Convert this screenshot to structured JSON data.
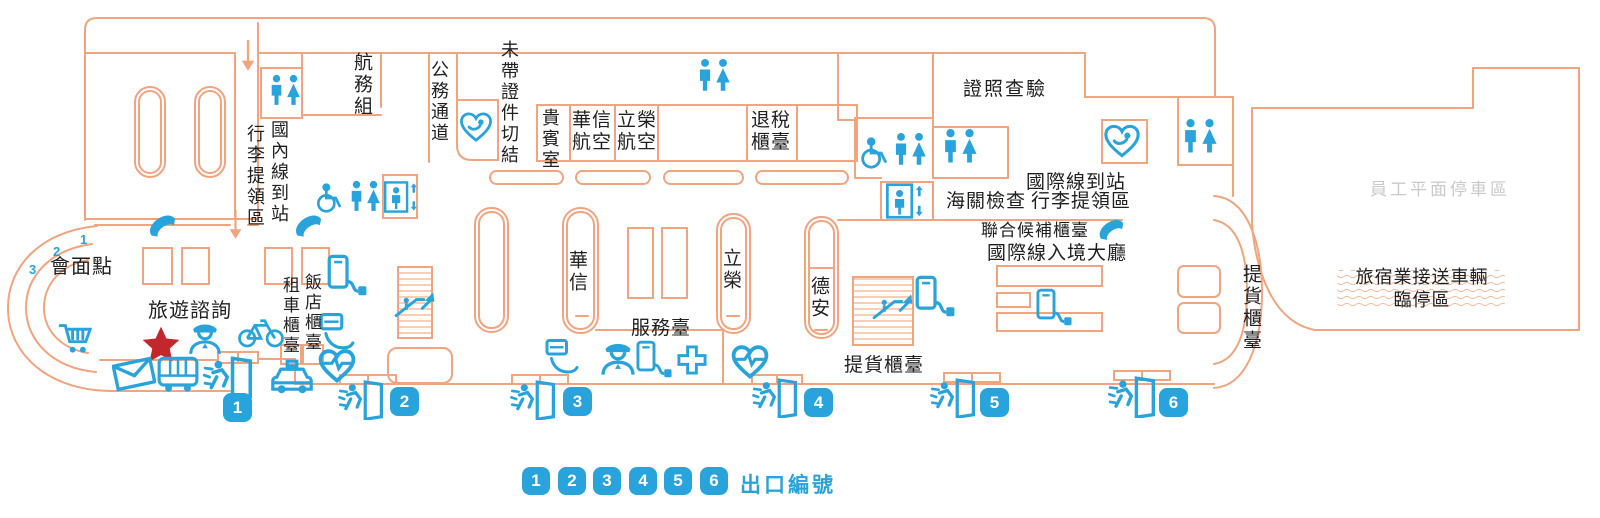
{
  "colors": {
    "wall_orange": "#f1a47e",
    "icon_blue": "#29a3dc",
    "badge_blue": "#29a3dc",
    "star_red": "#c1272d",
    "parking_gray": "#c9c9c9",
    "text_dark": "#1f1f1f"
  },
  "areas": {
    "flight_operations": "航務組",
    "domestic_baggage_claim": "行李提領區",
    "domestic_arrivals": "國內線到站",
    "official_passage": "公務通道",
    "no_document_affidavit": "未帶證件切結",
    "vip_lounge": "貴賓室",
    "mandarin_airlines": "華信\n航空",
    "uni_air": "立榮\n航空",
    "tax_refund_counter": "退稅\n櫃臺",
    "passport_inspection": "證照查驗",
    "customs_inspection": "海關檢查",
    "intl_arrivals": "國際線到站",
    "intl_baggage_claim": "行李提領區",
    "joint_standby_counter": "聯合候補櫃臺",
    "intl_arrival_hall": "國際線入境大廳",
    "carousel_mandarin": "華信",
    "carousel_uni": "立榮",
    "carousel_daily_air": "德安",
    "service_desk": "服務臺",
    "cargo_pickup_counter_south": "提貨櫃臺",
    "cargo_pickup_counter_east": "提貨櫃臺",
    "meeting_point": "會面點",
    "travel_information": "旅遊諮詢",
    "car_rental_counter": "租車櫃臺",
    "hotel_counter": "飯店櫃臺",
    "staff_parking": "員工平面停車區",
    "hotel_shuttle_zone": "旅宿業接送車輛\n臨停區"
  },
  "meeting_point": {
    "lane_numbers": [
      "1",
      "2",
      "3"
    ]
  },
  "exits": [
    "1",
    "2",
    "3",
    "4",
    "5",
    "6"
  ],
  "legend": {
    "title": "出口編號",
    "exit_numbers": [
      "1",
      "2",
      "3",
      "4",
      "5",
      "6"
    ]
  }
}
